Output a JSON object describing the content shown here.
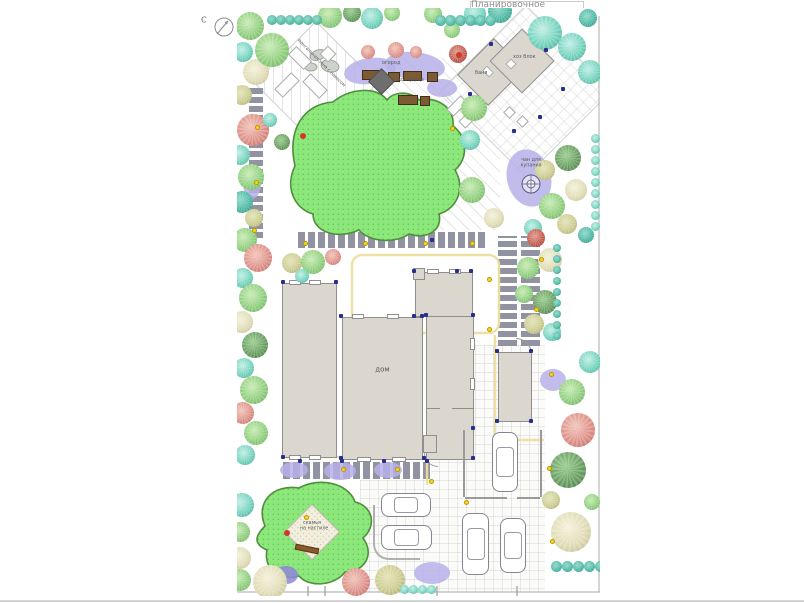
{
  "title": "Планировочное решение",
  "compass": {
    "north": "С"
  },
  "labels": {
    "bbq_zone": "мангальная зона с навесом",
    "firepit": "кострище",
    "vegetable_garden": "огород",
    "bathhouse": "баня",
    "utility_block": "хоз блок",
    "tub_line1": "чан для",
    "tub_line2": "купания",
    "house": "дом",
    "bench_line1": "скамья",
    "bench_line2": "на настиле"
  },
  "colors": {
    "lawn": "#8ce87a",
    "lawn_outline": "#4f8f3d",
    "paver": "#9193a2",
    "building": "#dbd7cf",
    "building_outline": "#8f8f8f",
    "garden_bed": "#7b5a34",
    "groundcover": "#b6b0e8",
    "tree_green": "#8cc97b",
    "tree_teal": "#66cbb8",
    "tree_red": "#dc8d84",
    "tree_beige": "#e0dcba",
    "tree_olive": "#c9c98f",
    "tree_dark_green": "#5f9e5d",
    "light_dot": "#ffd21e",
    "lamp_dot": "#27308f",
    "accent_red": "#cf3a2a",
    "lighting_line": "#ecdf9e"
  }
}
